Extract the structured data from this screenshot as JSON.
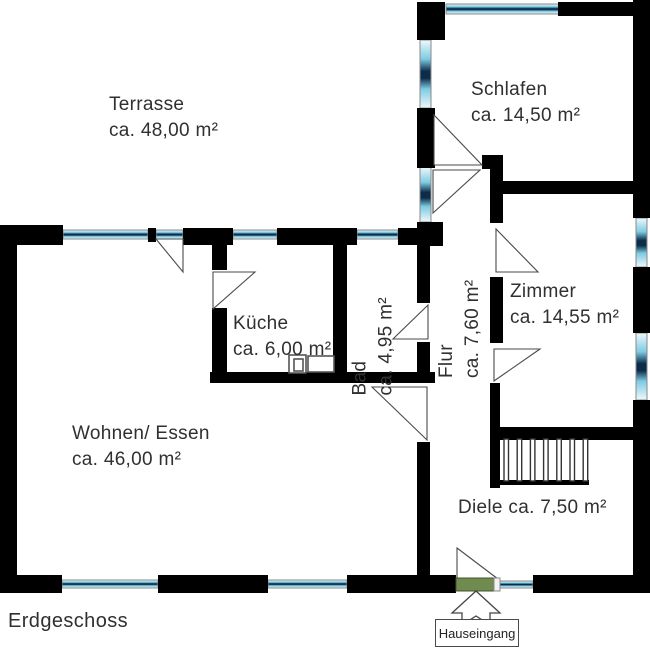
{
  "title": "Erdgeschoss",
  "entrance": {
    "label": "Hauseingang"
  },
  "rooms": {
    "terrasse": {
      "name": "Terrasse",
      "area": "ca. 48,00 m²"
    },
    "schlafen": {
      "name": "Schlafen",
      "area": "ca. 14,50 m²"
    },
    "kueche": {
      "name": "Küche",
      "area": "ca. 6,00 m²"
    },
    "bad": {
      "name": "Bad",
      "area": "ca. 4,95 m²"
    },
    "flur": {
      "name": "Flur",
      "area": "ca. 7,60 m²"
    },
    "zimmer": {
      "name": "Zimmer",
      "area": "ca. 14,55 m²"
    },
    "wohnen": {
      "name": "Wohnen/ Essen",
      "area": "ca. 46,00 m²"
    },
    "diele": {
      "name": "Diele",
      "area": "ca. 7,50 m²"
    }
  },
  "colors": {
    "wall": "#000000",
    "window_light": "#eef9fc",
    "window_mid": "#7ecbe2",
    "window_dark": "#0c2c49",
    "window_frame": "#8a8a8a",
    "swing_stroke": "#4a4a4a",
    "door_green": "#708b4f",
    "door_green_border": "#44552f",
    "door_tip": "#f2f2f2",
    "text": "#303030"
  },
  "plan": {
    "walls": [
      [
        417,
        2,
        28,
        38
      ],
      [
        558,
        2,
        78,
        14
      ],
      [
        633,
        0,
        17,
        218
      ],
      [
        633,
        267,
        17,
        66
      ],
      [
        633,
        400,
        17,
        193
      ],
      [
        417,
        108,
        18,
        60
      ],
      [
        417,
        222,
        26,
        24
      ],
      [
        0,
        225,
        63,
        20
      ],
      [
        148,
        228,
        8,
        14
      ],
      [
        183,
        228,
        50,
        17
      ],
      [
        277,
        228,
        80,
        17
      ],
      [
        398,
        228,
        22,
        17
      ],
      [
        0,
        225,
        17,
        368
      ],
      [
        0,
        575,
        62,
        18
      ],
      [
        158,
        575,
        110,
        18
      ],
      [
        347,
        575,
        109,
        18
      ],
      [
        533,
        575,
        117,
        18
      ],
      [
        417,
        245,
        13,
        58
      ],
      [
        417,
        342,
        13,
        39
      ],
      [
        417,
        442,
        13,
        141
      ],
      [
        212,
        243,
        15,
        27
      ],
      [
        212,
        308,
        15,
        67
      ],
      [
        210,
        372,
        225,
        11
      ],
      [
        333,
        243,
        14,
        132
      ],
      [
        502,
        181,
        148,
        13
      ],
      [
        482,
        155,
        21,
        14
      ],
      [
        490,
        168,
        13,
        55
      ],
      [
        490,
        277,
        13,
        66
      ],
      [
        490,
        383,
        10,
        105
      ],
      [
        490,
        427,
        160,
        13
      ],
      [
        492,
        480,
        97,
        5
      ]
    ],
    "windows": [
      {
        "dir": "h",
        "rect": [
          446,
          4,
          114,
          10
        ]
      },
      {
        "dir": "h",
        "rect": [
          63,
          230,
          85,
          9
        ]
      },
      {
        "dir": "h",
        "rect": [
          156,
          230,
          27,
          9
        ]
      },
      {
        "dir": "h",
        "rect": [
          233,
          230,
          44,
          9
        ]
      },
      {
        "dir": "h",
        "rect": [
          357,
          230,
          41,
          9
        ]
      },
      {
        "dir": "h",
        "rect": [
          62,
          580,
          96,
          8
        ]
      },
      {
        "dir": "h",
        "rect": [
          268,
          580,
          79,
          8
        ]
      },
      {
        "dir": "h",
        "rect": [
          499,
          581,
          34,
          7
        ]
      },
      {
        "dir": "v",
        "rect": [
          420,
          40,
          11,
          68
        ]
      },
      {
        "dir": "v",
        "rect": [
          420,
          167,
          11,
          55
        ]
      },
      {
        "dir": "v",
        "rect": [
          636,
          218,
          11,
          49
        ]
      },
      {
        "dir": "v",
        "rect": [
          636,
          333,
          11,
          67
        ]
      }
    ],
    "door_swings": [
      "156,239 183,239 183,272",
      "434,115 482,165 434,165",
      "433,170 480,170 433,213",
      "496,229 538,272 496,272",
      "494,349 540,349 494,381",
      "428,305 428,339 393,339",
      "213,272 255,272 213,309",
      "372,387 427,387 427,440",
      "457,548 498,579 457,579"
    ],
    "kitchen_fixtures": [
      [
        289,
        355,
        17,
        18
      ],
      [
        294,
        359,
        9,
        12
      ],
      [
        308,
        356,
        26,
        16
      ]
    ],
    "stairs": {
      "x0": 504,
      "step": 13.2,
      "count": 7,
      "y": 439,
      "w": 4.5,
      "h": 42
    },
    "entry_door": {
      "leaf": [
        456,
        578,
        38,
        13
      ],
      "tip": [
        494,
        578,
        6,
        13
      ]
    },
    "entry_arrow": "476,591 500,613 490,613 490,625 476,616 462,625 462,613 452,613"
  }
}
